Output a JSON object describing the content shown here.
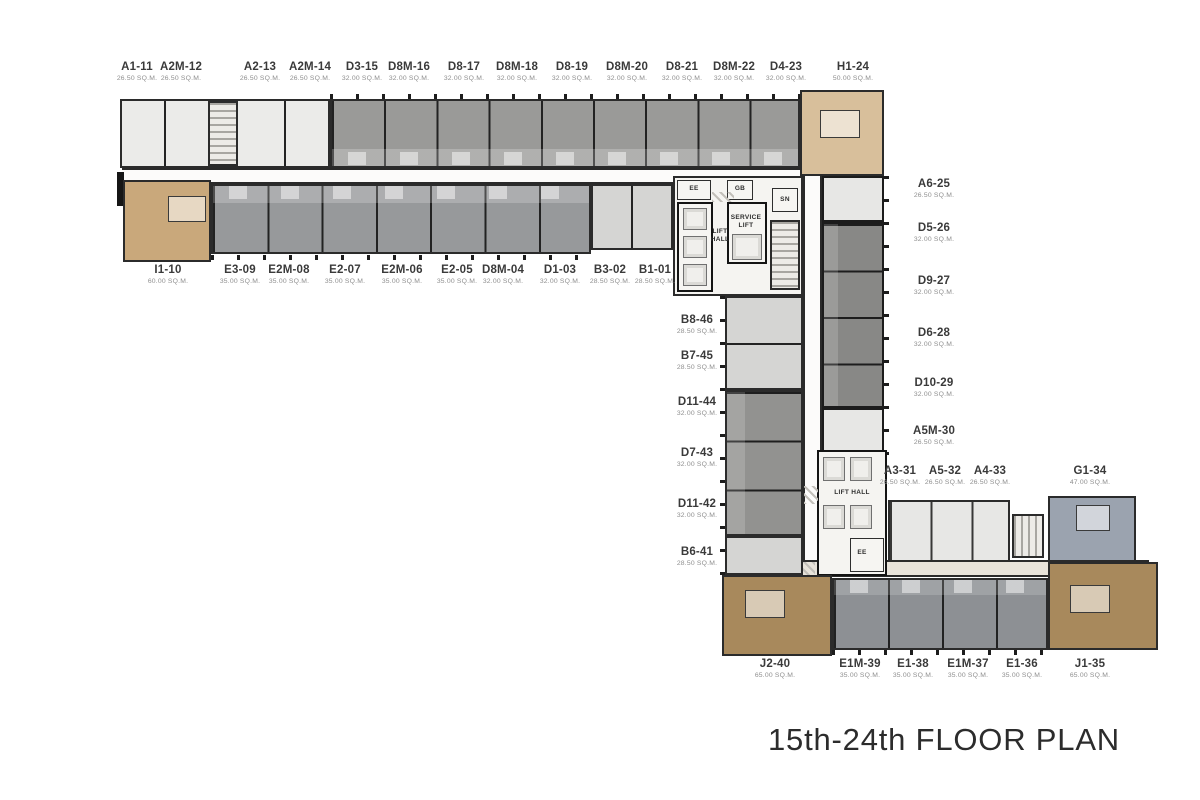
{
  "title": "15th-24th FLOOR PLAN",
  "units": {
    "top_row": [
      {
        "id": "A1-11",
        "area": "26.50 SQ.M."
      },
      {
        "id": "A2M-12",
        "area": "26.50 SQ.M."
      },
      {
        "id": "A2-13",
        "area": "26.50 SQ.M."
      },
      {
        "id": "A2M-14",
        "area": "26.50 SQ.M."
      },
      {
        "id": "D3-15",
        "area": "32.00 SQ.M."
      },
      {
        "id": "D8M-16",
        "area": "32.00 SQ.M."
      },
      {
        "id": "D8-17",
        "area": "32.00 SQ.M."
      },
      {
        "id": "D8M-18",
        "area": "32.00 SQ.M."
      },
      {
        "id": "D8-19",
        "area": "32.00 SQ.M."
      },
      {
        "id": "D8M-20",
        "area": "32.00 SQ.M."
      },
      {
        "id": "D8-21",
        "area": "32.00 SQ.M."
      },
      {
        "id": "D8M-22",
        "area": "32.00 SQ.M."
      },
      {
        "id": "D4-23",
        "area": "32.00 SQ.M."
      },
      {
        "id": "H1-24",
        "area": "50.00 SQ.M."
      }
    ],
    "second_row": [
      {
        "id": "I1-10",
        "area": "60.00 SQ.M."
      },
      {
        "id": "E3-09",
        "area": "35.00 SQ.M."
      },
      {
        "id": "E2M-08",
        "area": "35.00 SQ.M."
      },
      {
        "id": "E2-07",
        "area": "35.00 SQ.M."
      },
      {
        "id": "E2M-06",
        "area": "35.00 SQ.M."
      },
      {
        "id": "E2-05",
        "area": "35.00 SQ.M."
      },
      {
        "id": "D8M-04",
        "area": "32.00 SQ.M."
      },
      {
        "id": "D1-03",
        "area": "32.00 SQ.M."
      },
      {
        "id": "B3-02",
        "area": "28.50 SQ.M."
      },
      {
        "id": "B1-01",
        "area": "28.50 SQ.M."
      }
    ],
    "right_column": [
      {
        "id": "A6-25",
        "area": "26.50 SQ.M."
      },
      {
        "id": "D5-26",
        "area": "32.00 SQ.M."
      },
      {
        "id": "D9-27",
        "area": "32.00 SQ.M."
      },
      {
        "id": "D6-28",
        "area": "32.00 SQ.M."
      },
      {
        "id": "D10-29",
        "area": "32.00 SQ.M."
      },
      {
        "id": "A5M-30",
        "area": "26.50 SQ.M."
      }
    ],
    "mid_column": [
      {
        "id": "B8-46",
        "area": "28.50 SQ.M."
      },
      {
        "id": "B7-45",
        "area": "28.50 SQ.M."
      },
      {
        "id": "D11-44",
        "area": "32.00 SQ.M."
      },
      {
        "id": "D7-43",
        "area": "32.00 SQ.M."
      },
      {
        "id": "D11-42",
        "area": "32.00 SQ.M."
      },
      {
        "id": "B6-41",
        "area": "28.50 SQ.M."
      }
    ],
    "lower_row": [
      {
        "id": "A3-31",
        "area": "26.50 SQ.M."
      },
      {
        "id": "A5-32",
        "area": "26.50 SQ.M."
      },
      {
        "id": "A4-33",
        "area": "26.50 SQ.M."
      },
      {
        "id": "G1-34",
        "area": "47.00 SQ.M."
      }
    ],
    "bottom_row": [
      {
        "id": "J2-40",
        "area": "65.00 SQ.M."
      },
      {
        "id": "E1M-39",
        "area": "35.00 SQ.M."
      },
      {
        "id": "E1-38",
        "area": "35.00 SQ.M."
      },
      {
        "id": "E1M-37",
        "area": "35.00 SQ.M."
      },
      {
        "id": "E1-36",
        "area": "35.00 SQ.M."
      },
      {
        "id": "J1-35",
        "area": "65.00 SQ.M."
      }
    ]
  },
  "core": {
    "lift_hall_upper": "LIFT HALL",
    "service_lift": "SERVICE LIFT",
    "ee_upper": "EE",
    "gb": "GB",
    "sn": "SN",
    "lift_hall_lower": "LIFT HALL",
    "ee_lower": "EE"
  },
  "colors": {
    "unit_white": "#ebebe9",
    "unit_gray": "#9a9a98",
    "unit_gray2": "#97999b",
    "unit_gray_dark": "#888886",
    "unit_gray_mid": "#929290",
    "unit_gray_bottom": "#8d9094",
    "unit_light": "#d5d5d3",
    "unit_pale": "#e7e7e5",
    "unit_tan": "#c9a87b",
    "unit_tan_light": "#d8bf9b",
    "unit_brown": "#a8895c",
    "unit_bluegray": "#9ba3af",
    "corridor_beige": "#e8e3da",
    "core_bg": "#f5f4f1"
  }
}
